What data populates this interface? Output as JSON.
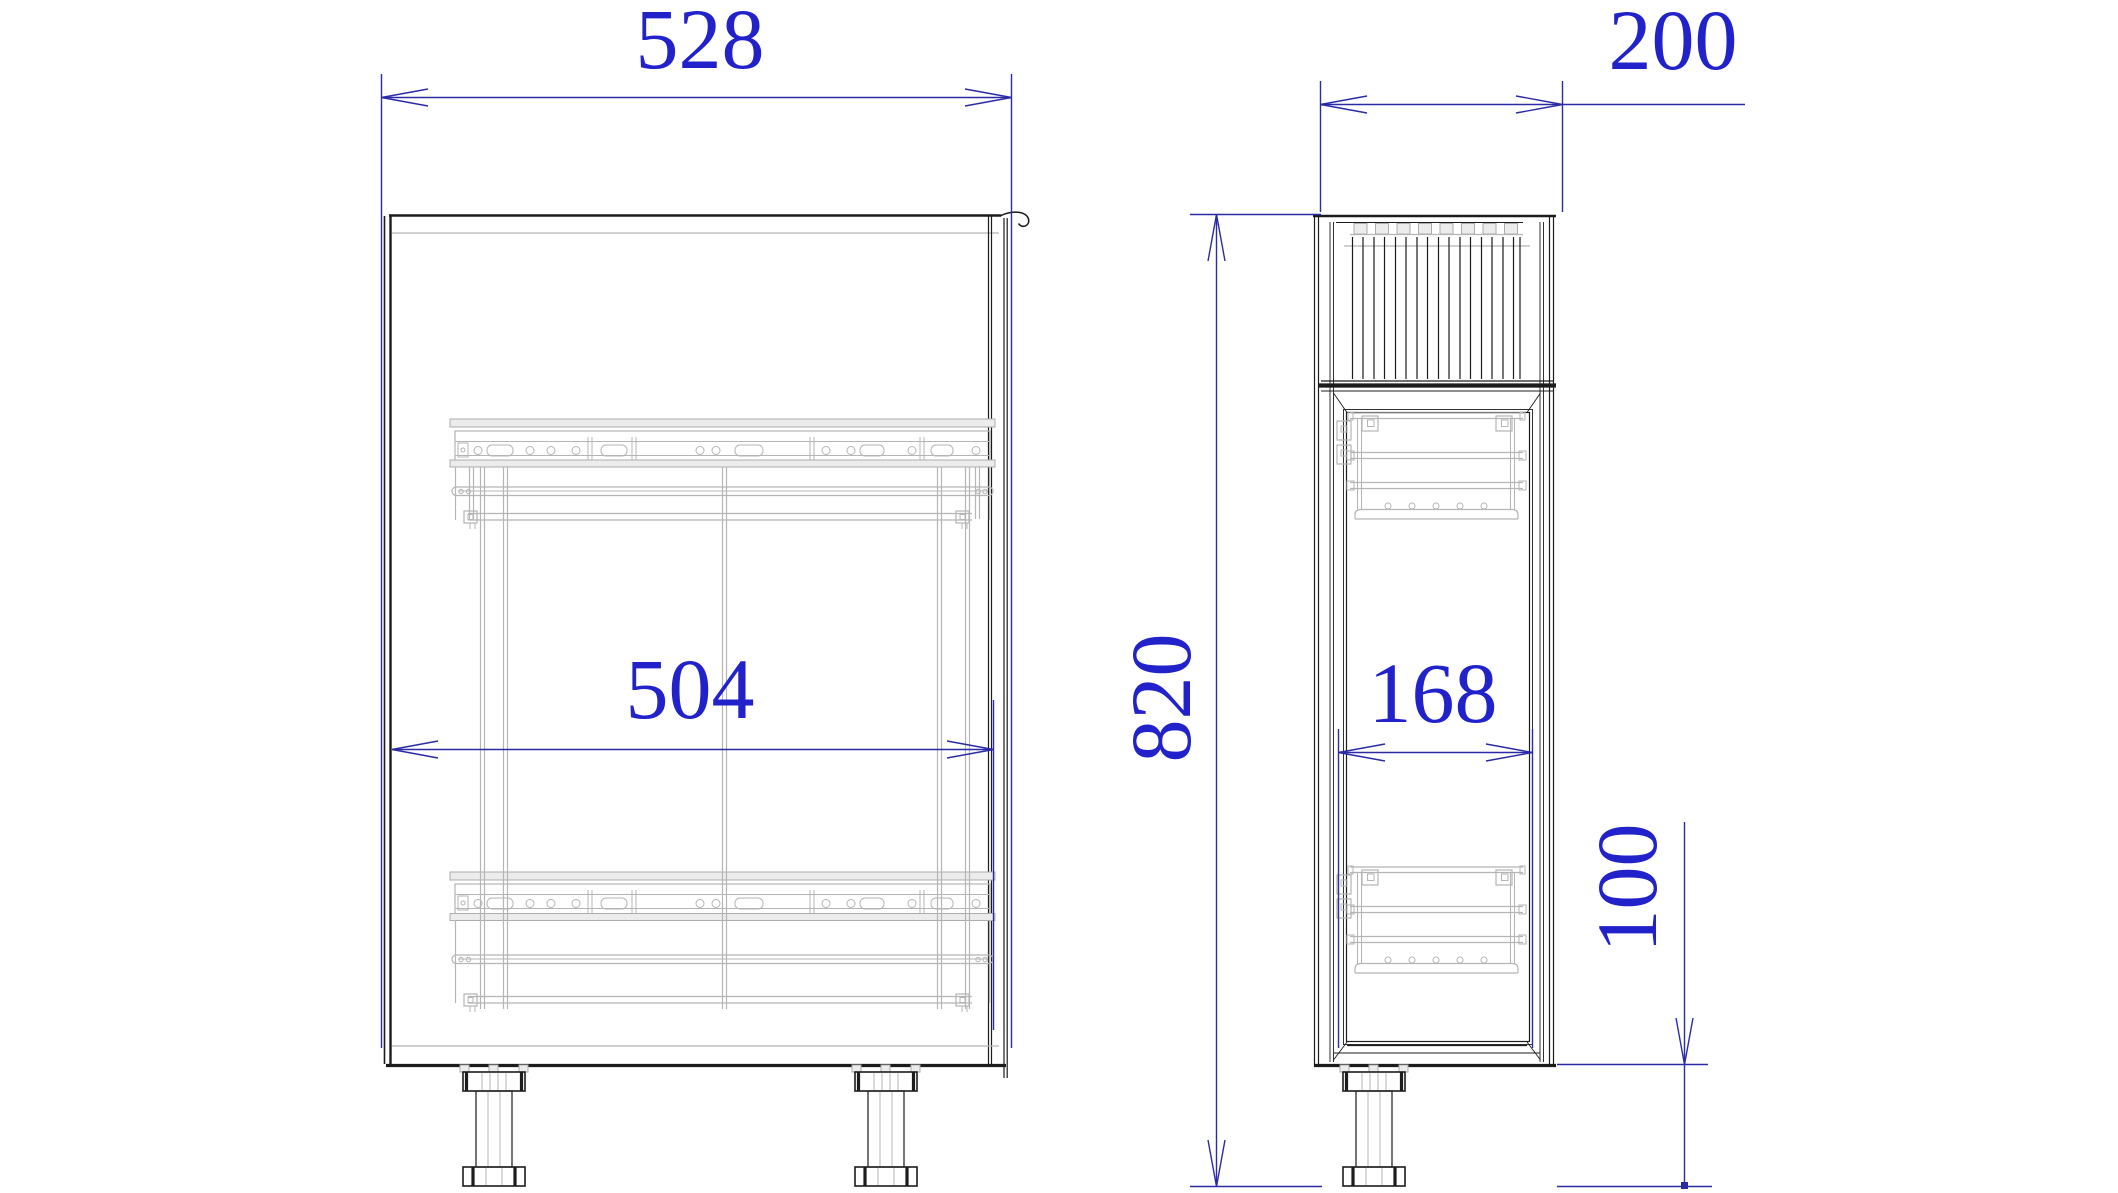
{
  "drawing": {
    "type": "cad-elevation-drawing",
    "views": [
      "front-elevation",
      "side-elevation"
    ],
    "dimensions": {
      "front_overall_width": "528",
      "front_internal_width": "504",
      "side_overall_depth": "200",
      "overall_height": "820",
      "side_internal_clearance": "168",
      "leg_height": "100"
    },
    "colors": {
      "dimension_text": "#2222cb",
      "dimension_line": "#2b2ba6",
      "outline": "#1c1c1c",
      "detail": "#b5b5b5",
      "background": "#ffffff"
    }
  }
}
